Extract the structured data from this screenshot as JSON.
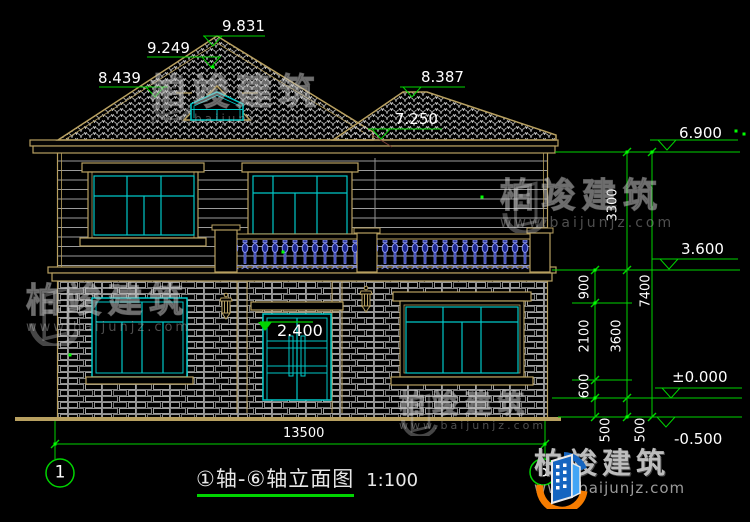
{
  "title_block": {
    "title": "①轴-⑥轴立面图",
    "scale_label": "1:100"
  },
  "axes": {
    "left": "1",
    "right": "6"
  },
  "elevations": {
    "ridge": "9.831",
    "ridge_tile": "9.249",
    "left_slope": "8.439",
    "right_ridge": "8.387",
    "right_wing_eave": "7.250",
    "main_eave": "6.900",
    "second_floor": "3.600",
    "first_floor": "±0.000",
    "site": "-0.500",
    "door_top": "2.400"
  },
  "dimensions": {
    "overall_width": "13500",
    "floor_chain": [
      "900",
      "2100",
      "600",
      "500"
    ],
    "level_chain": [
      "3300",
      "3600",
      "500"
    ],
    "total_chain": [
      "7400"
    ]
  },
  "watermark": {
    "brand": "柏竣建筑",
    "website": "www.baijunjz.com"
  },
  "brand_logo": {
    "brand": "柏竣建筑",
    "website": "www.baijunjz.com"
  },
  "colors": {
    "dimension_green": "#00d400",
    "frame_tan": "#b8a060",
    "glazing_cyan": "#00c8c8",
    "baluster_blue": "#5b6be0",
    "background": "#000000"
  }
}
